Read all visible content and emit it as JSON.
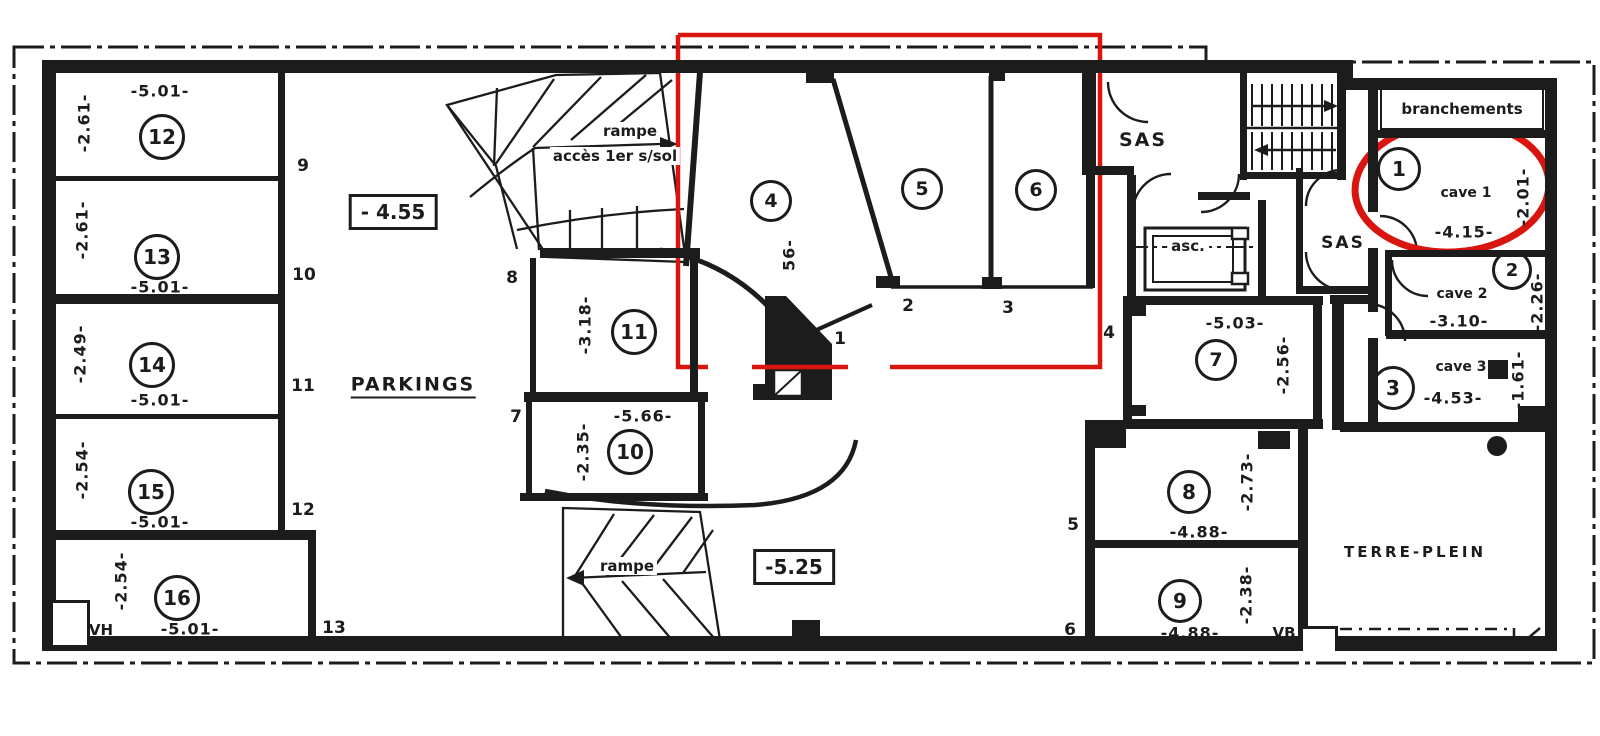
{
  "plan": {
    "area_label": "PARKINGS",
    "upper_ramp": {
      "line1": "rampe",
      "line2": "accès 1er s/sol"
    },
    "lower_ramp": {
      "label": "rampe"
    },
    "levels": {
      "upper": "- 4.55",
      "lower": "-5.25"
    },
    "rooms": {
      "sas_top": "SAS",
      "sas_right": "SAS",
      "elevator": "asc.",
      "branchements": "branchements",
      "terre_plein": "TERRE-PLEIN"
    },
    "vents": {
      "vh": "VH",
      "vb": "VB"
    },
    "parkings": {
      "p4": {
        "num": "4",
        "dim_partial": "56-"
      },
      "p5": {
        "num": "5"
      },
      "p6": {
        "num": "6"
      },
      "p7": {
        "num": "7",
        "width": "-5.03-",
        "depth": "-2.56-"
      },
      "p8": {
        "num": "8",
        "width": "-4.88-",
        "depth": "-2.73-"
      },
      "p9": {
        "num": "9",
        "width": "-4.88-",
        "depth": "-2.38-"
      },
      "p10": {
        "num": "10",
        "width": "-5.66-",
        "depth": "-2.35-"
      },
      "p11": {
        "num": "11",
        "depth": "-3.18-"
      },
      "p12": {
        "num": "12",
        "width": "-5.01-",
        "depth": "-2.61-"
      },
      "p13": {
        "num": "13",
        "width": "-5.01-",
        "depth": "-2.61-"
      },
      "p14": {
        "num": "14",
        "width": "-5.01-",
        "depth": "-2.49-"
      },
      "p15": {
        "num": "15",
        "width": "-5.01-",
        "depth": "-2.54-"
      },
      "p16": {
        "num": "16",
        "width": "-5.01-",
        "depth": "-2.54-"
      }
    },
    "caves": {
      "c1": {
        "num": "1",
        "name": "cave 1",
        "width": "-4.15-",
        "depth": "-2.01-"
      },
      "c2": {
        "num": "2",
        "name": "cave 2",
        "width": "-3.10-",
        "depth": "-2.26-"
      },
      "c3": {
        "num": "3",
        "name": "cave 3",
        "width": "-4.53-",
        "depth": "-1.61-"
      }
    },
    "markers": {
      "m1": "1",
      "m2": "2",
      "m3": "3",
      "m4": "4",
      "m5": "5",
      "m6": "6",
      "m7": "7",
      "m8": "8",
      "m9": "9",
      "m10": "10",
      "m11": "11",
      "m12": "12",
      "m13": "13"
    }
  },
  "annotations": {
    "color": "#d9150f"
  }
}
